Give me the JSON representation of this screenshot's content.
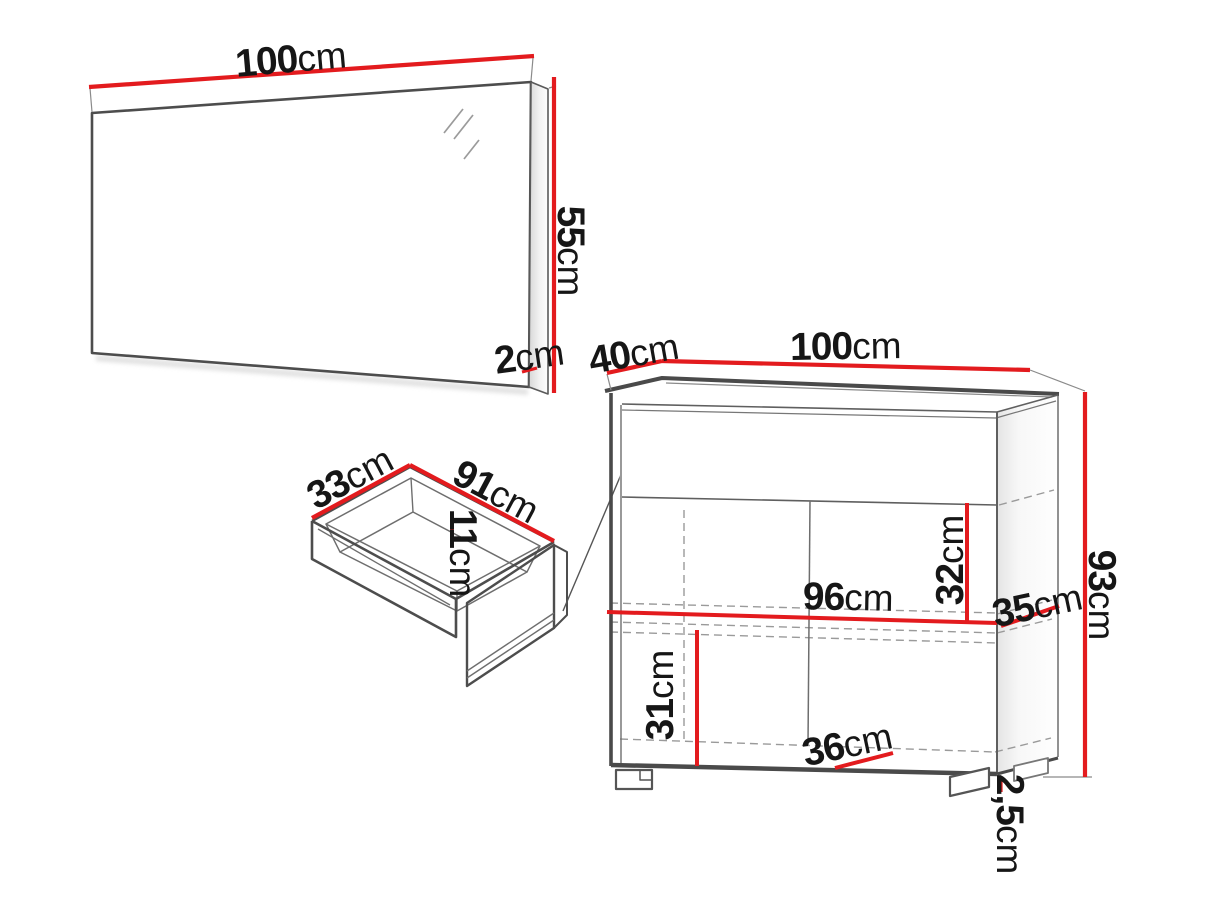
{
  "page": {
    "background": "#ffffff",
    "type": "furniture-dimension-diagram"
  },
  "colors": {
    "dimension_line": "#e31b1e",
    "outline": "#4d4d4d",
    "text": "#161616"
  },
  "figures": {
    "mirror": {
      "label": "wall mirror",
      "width": {
        "value": "100",
        "unit": "cm"
      },
      "height": {
        "value": "55",
        "unit": "cm"
      },
      "depth": {
        "value": "2",
        "unit": "cm"
      }
    },
    "drawer": {
      "label": "drawer",
      "depth": {
        "value": "33",
        "unit": "cm"
      },
      "width": {
        "value": "91",
        "unit": "cm"
      },
      "inner_height": {
        "value": "11",
        "unit": "cm"
      }
    },
    "cabinet": {
      "label": "chest cabinet",
      "depth": {
        "value": "40",
        "unit": "cm"
      },
      "width": {
        "value": "100",
        "unit": "cm"
      },
      "height": {
        "value": "93",
        "unit": "cm"
      },
      "upper_inner_height": {
        "value": "32",
        "unit": "cm"
      },
      "inner_width": {
        "value": "96",
        "unit": "cm"
      },
      "shelf_depth": {
        "value": "35",
        "unit": "cm"
      },
      "lower_inner_height": {
        "value": "31",
        "unit": "cm"
      },
      "door_width": {
        "value": "36",
        "unit": "cm"
      },
      "foot_height": {
        "value": "2,5",
        "unit": "cm"
      }
    }
  }
}
